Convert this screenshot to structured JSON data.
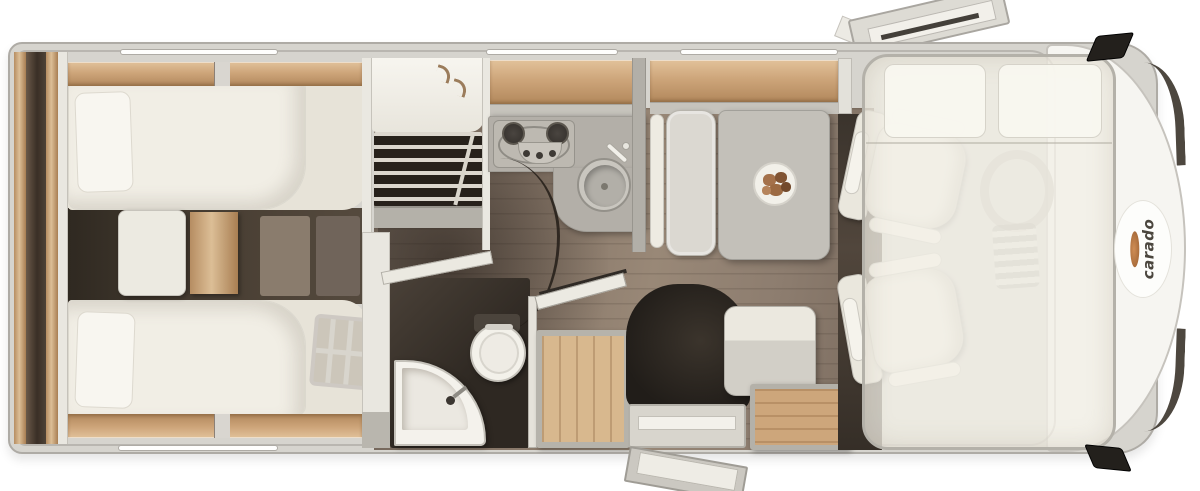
{
  "brand": {
    "logo_text": "carado"
  },
  "palette": {
    "bg": "#ffffff",
    "shell": "#d6d4ce",
    "shell-border": "#aeaba5",
    "wall": "#b5b2ab",
    "wood": "#cda57a",
    "wood-floor": "#d8b88e",
    "floor": "#8d7d6f",
    "floor-dark": "#40372e",
    "dark": "#2e2822",
    "cream": "#f1eee5",
    "counter": "#b3afa8",
    "table": "#c3c0b9",
    "bench": "#dbd8d1",
    "accent": "#cf8d55",
    "ink": "#4b463e"
  },
  "icons": {
    "roof-hatch": "angled-panels",
    "wing-mirror": "black-parallelogram",
    "window": "white-bar",
    "hanger": "css-hook",
    "stove-burner": "dark-circle",
    "control-knob": "small-dot",
    "sink": "circle-basin",
    "faucet": "rotated-lever",
    "plate-of-food": "circle-with-blobs",
    "toilet": "round-bowl",
    "corner-washbasin": "quarter-round",
    "shower-grate": "wood-planks",
    "steering-wheel": "faint-ring",
    "dashboard-vents": "striped-block",
    "bed-ladder": "grid-frame",
    "clothes-rail-slats": "horizontal-slats",
    "windshield-pillar": "dark-arc"
  }
}
